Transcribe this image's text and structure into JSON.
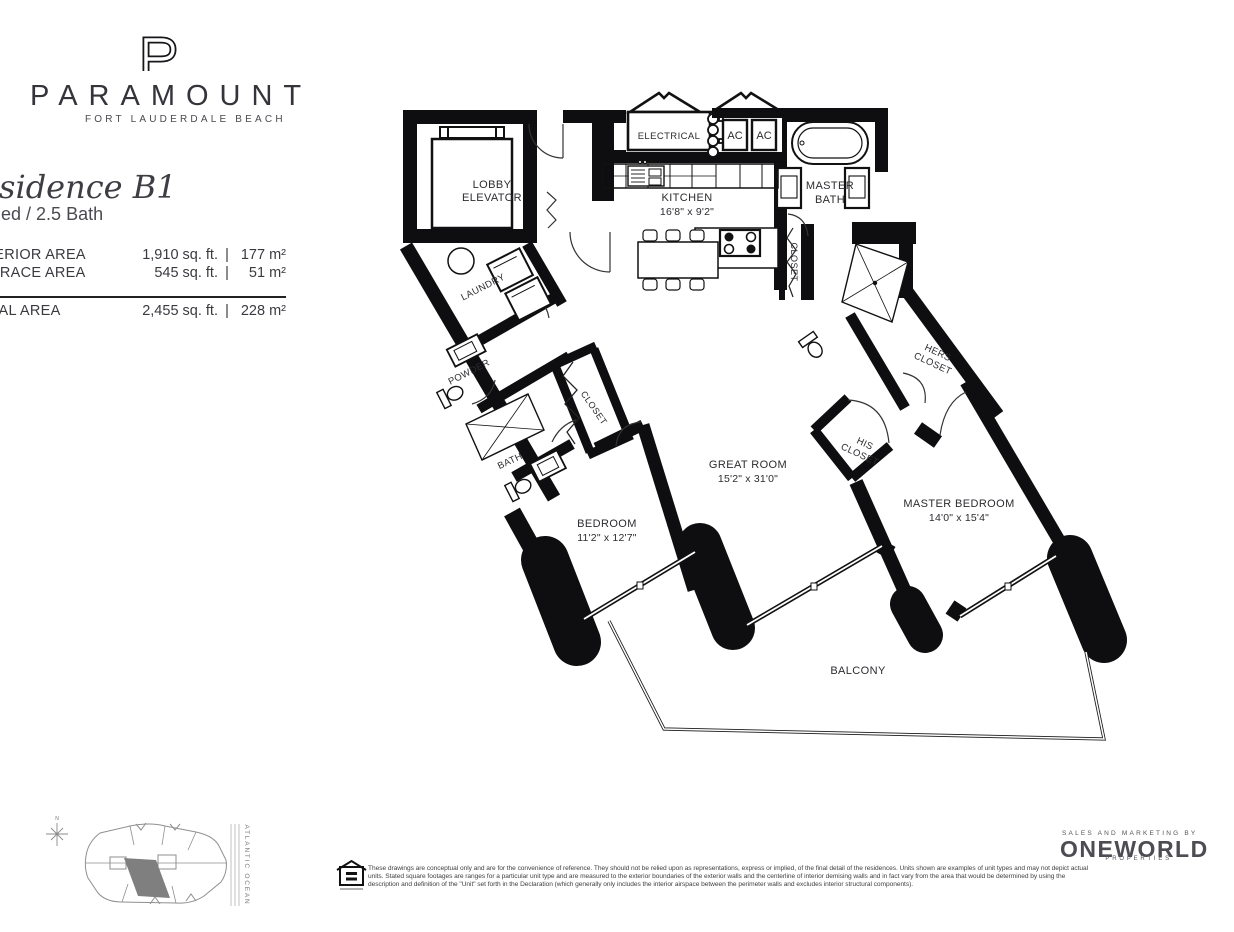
{
  "brand": {
    "monogram": "P",
    "name": "PARAMOUNT",
    "location": "FORT LAUDERDALE BEACH"
  },
  "residence": {
    "title": "Residence B1",
    "config": "2 Bed / 2.5 Bath",
    "divider": "|",
    "areas": [
      {
        "label": "INTERIOR AREA",
        "imperial": "1,910 sq. ft.",
        "metric": "177 m²"
      },
      {
        "label": "TERRACE AREA",
        "imperial": "545 sq. ft.",
        "metric": "51 m²"
      },
      {
        "label": "TOTAL AREA",
        "imperial": "2,455 sq. ft.",
        "metric": "228 m²"
      }
    ]
  },
  "plan": {
    "lobby_elevator_1": "LOBBY",
    "lobby_elevator_2": "ELEVATOR",
    "electrical": "ELECTRICAL",
    "ac_left": "AC",
    "ac_right": "AC",
    "kitchen_name": "KITCHEN",
    "kitchen_dims": "16'8\" x 9'2\"",
    "master_bath_1": "MASTER",
    "master_bath_2": "BATH",
    "master_closet": "CLOSET",
    "laundry": "LAUNDRY",
    "powder": "POWDER",
    "bath": "BATH",
    "bedroom_closet": "CLOSET",
    "bedroom_name": "BEDROOM",
    "bedroom_dims": "11'2\" x 12'7\"",
    "great_room_name": "GREAT ROOM",
    "great_room_dims": "15'2\" x 31'0\"",
    "his_closet_1": "HIS",
    "his_closet_2": "CLOSET",
    "hers_closet_1": "HERS",
    "hers_closet_2": "CLOSET",
    "master_bedroom_name": "MASTER BEDROOM",
    "master_bedroom_dims": "14'0\" x 15'4\"",
    "balcony": "BALCONY"
  },
  "site_key": {
    "ocean": "ATLANTIC OCEAN",
    "compass": "N"
  },
  "footer": {
    "marketing_tagline": "SALES AND MARKETING BY",
    "marketing_brand": "ONEWORLD",
    "marketing_sub": "PROPERTIES",
    "disclaimer_1": "These drawings are conceptual only and are for the convenience of reference. They should not be relied upon as representations, express or implied, of the final detail of the residences. Units shown are examples of unit types and may not depict actual",
    "disclaimer_2": "units. Stated square footages are ranges for a particular unit type and are measured to the exterior boundaries of the exterior walls and the centerline of interior demising walls and in fact vary from the area that would be determined by using the",
    "disclaimer_3": "description and definition of the \"Unit\" set forth in the Declaration (which generally only includes the interior airspace between the perimeter walls and excludes interior structural components)."
  }
}
